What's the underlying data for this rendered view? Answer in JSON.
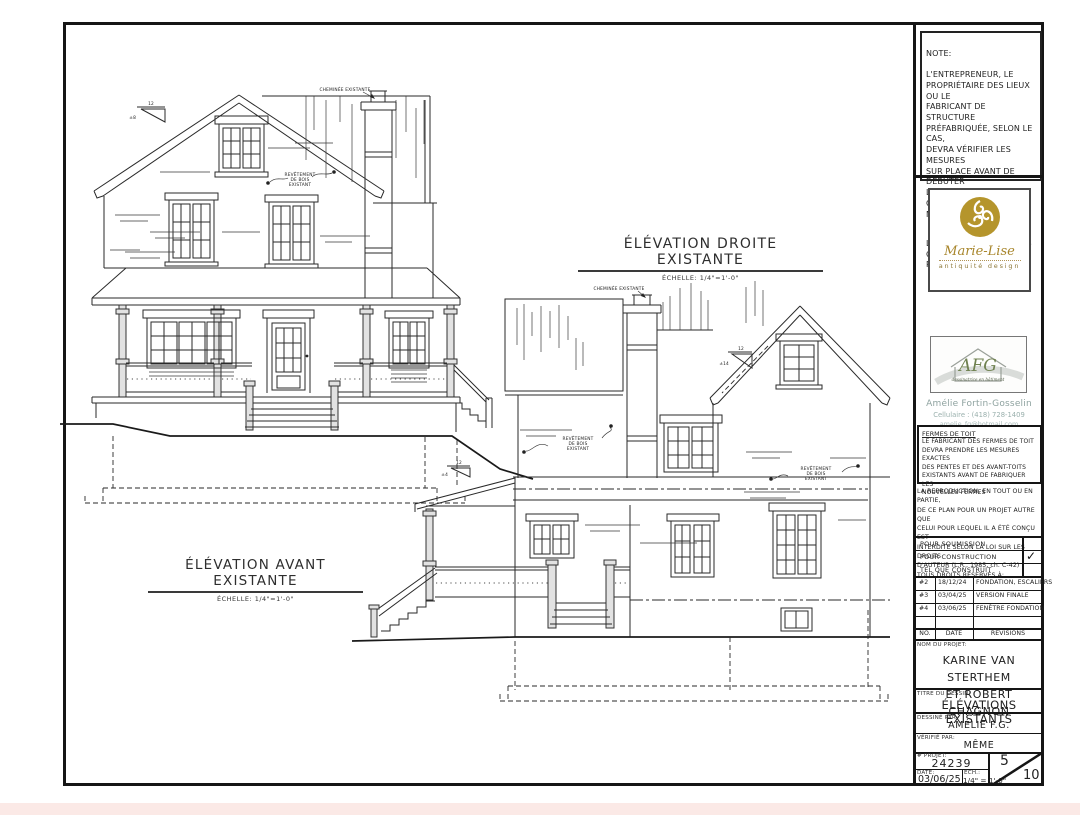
{
  "colors": {
    "gold": "#ab8c2e",
    "afg_green": "#6f8150",
    "bottom_strip": "#fbe9e6",
    "line": "#151515"
  },
  "notes": {
    "title": "NOTE:",
    "body": "L'ENTREPRENEUR, LE\nPROPRIÉTAIRE DES LIEUX OU LE\nFABRICANT DE STRUCTURE\nPRÉFABRIQUÉE, SELON LE CAS,\nDEVRA VÉRIFIER LES MESURES\nSUR PLACE AVANT DE DÉBUTER\nLES TRAVAUX OU DE\nCOMMANDER LES MATÉRIAUX.",
    "priority": "LES COTES ET LES NOTES ONT\nPRIORITÉ SUR LE DESSIN"
  },
  "logos": {
    "marie_lise": {
      "name": "Marie-Lise",
      "tagline": "antiquité design"
    },
    "afg": {
      "initials": "AFG",
      "tagline": "dessinatrice en bâtiment",
      "person": "Amélie Fortin-Gosselin",
      "phone": "Cellulaire : (418) 728-1409",
      "email": "amelie_fg@hotmail.com"
    }
  },
  "fermes": {
    "title": "FERMES DE TOIT",
    "body": "LE FABRICANT DES FERMES DE TOIT\nDEVRA PRENDRE LES MESURES EXACTES\nDES PENTES ET DES AVANT-TOITS\nEXISTANTS AVANT DE FABRIQUER LES\nNOUVELLES FERMES"
  },
  "copyright": "LA REPRODUCTION, EN TOUT OU EN PARTIE,\nDE CE PLAN POUR UN PROJET AUTRE QUE\nCELUI POUR LEQUEL IL A ÉTÉ CONÇU EST\nINTERDITE SELON LA LOI SUR LES DROITS\nD'AUTEUR (L.R., 1985, ch. C-42)\nTOUS DROITS RÉSERVÉS À:",
  "status_rows": [
    {
      "label": "POUR SOUMISSION",
      "check": ""
    },
    {
      "label": "POUR CONSTRUCTION",
      "check": "✓"
    },
    {
      "label": "TEL QUE CONSTRUIT",
      "check": ""
    }
  ],
  "revisions": {
    "rows": [
      {
        "no": "#2",
        "date": "18/12/24",
        "desc": "FONDATION, ESCALIERS"
      },
      {
        "no": "#3",
        "date": "03/04/25",
        "desc": "VERSION FINALE"
      },
      {
        "no": "#4",
        "date": "03/06/25",
        "desc": "FENÊTRE FONDATION"
      },
      {
        "no": "",
        "date": "",
        "desc": ""
      }
    ],
    "header": {
      "no": "NO.",
      "date": "DATE",
      "desc": "RÉVISIONS"
    }
  },
  "title_block": {
    "project_label": "NOM DU PROJET:",
    "project_line1": "KARINE VAN STERTHEM",
    "project_line2": "ET ROBERT CHAGNON",
    "drawing_title_label": "TITRE DU DESSIN:",
    "drawing_title": "ÉLÉVATIONS EXISTANTS",
    "drawn_by_label": "DESSINÉ PAR:",
    "drawn_by": "AMÉLIE F.G.",
    "checked_by_label": "VÉRIFIÉ PAR:",
    "checked_by": "MÊME",
    "project_no_label": "# PROJET:",
    "project_no": "24239",
    "date_label": "DATE:",
    "date": "03/06/25",
    "scale_label": "ÉCH.:",
    "scale": "1/4\" = 1'-0\"",
    "sheet_no": "5",
    "sheet_total": "10"
  },
  "drawings": {
    "front": {
      "title": "ÉLÉVATION AVANT EXISTANTE",
      "scale": "ÉCHELLE:  1/4\"=1'-0\""
    },
    "right": {
      "title": "ÉLÉVATION DROITE EXISTANTE",
      "scale": "ÉCHELLE:  1/4\"=1'-0\""
    },
    "annotations": {
      "chimney": "CHEMINÉE EXISTANTE",
      "siding_l1": "REVÊTEMENT",
      "siding_l2": "DE BOIS",
      "siding_l3": "EXISTANT",
      "slope_run": "12",
      "slope_front_main": "±8",
      "slope_front_porch": "±4",
      "slope_right_gable": "±14"
    }
  }
}
